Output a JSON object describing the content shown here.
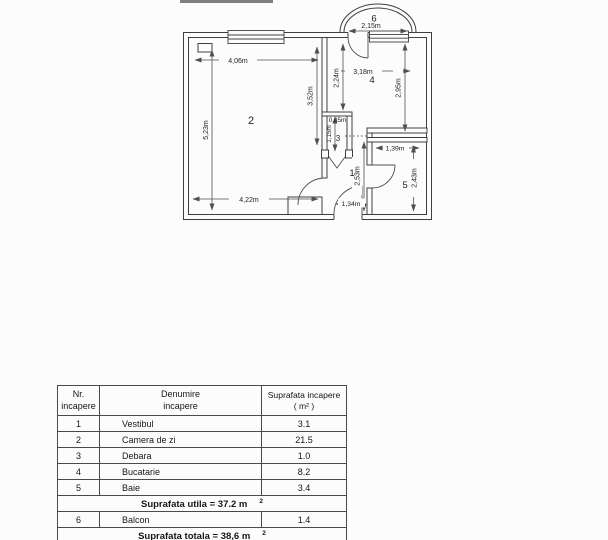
{
  "plan": {
    "room_numbers": {
      "r1": "1",
      "r2": "2",
      "r3": "3",
      "r4": "4",
      "r5": "5",
      "r6": "6"
    },
    "dims": {
      "d406": "4,06m",
      "d523": "5,23m",
      "d422": "4,22m",
      "d352": "3,52m",
      "d215": "2,15m",
      "d318": "3,18m",
      "d224": "2,24m",
      "d295": "2,95m",
      "d085": "0,85m",
      "d115": "1,15m",
      "d139": "1,39m",
      "d253": "2,53m",
      "d243": "2,43m",
      "d134": "1,34m"
    }
  },
  "table": {
    "header": {
      "col1_line1": "Nr.",
      "col1_line2": "incapere",
      "col2_line1": "Denumire",
      "col2_line2": "incapere",
      "col3_line1": "Suprafata incapere",
      "col3_line2": "( m² )"
    },
    "rows": [
      {
        "nr": "1",
        "name": "Vestibul",
        "area": "3.1"
      },
      {
        "nr": "2",
        "name": "Camera de zi",
        "area": "21.5"
      },
      {
        "nr": "3",
        "name": "Debara",
        "area": "1.0"
      },
      {
        "nr": "4",
        "name": "Bucatarie",
        "area": "8.2"
      },
      {
        "nr": "5",
        "name": "Baie",
        "area": "3.4"
      }
    ],
    "utila": {
      "text": "Suprafata utila = 37.2 m",
      "sup": "2"
    },
    "balcon": {
      "nr": "6",
      "name": "Balcon",
      "area": "1.4"
    },
    "totala": {
      "text": "Suprafata totala = 38,6 m",
      "sup": "2"
    }
  },
  "colors": {
    "wall_line": "#3f3f3f",
    "dim_line": "#4f4f4f",
    "text": "#1f1f1f",
    "background": "#fcfcfc",
    "table_border": "#4a4a4a"
  }
}
